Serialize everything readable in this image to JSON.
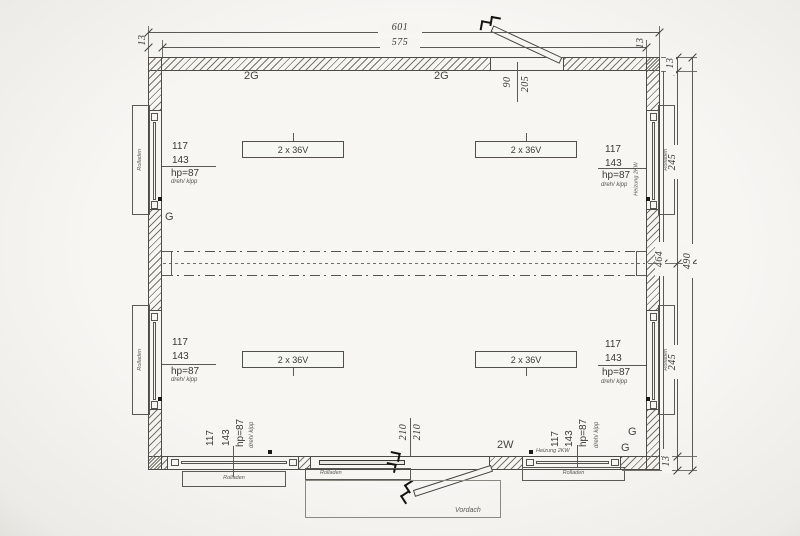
{
  "dimensions": {
    "outer_width": "601",
    "inner_width": "575",
    "wall_thickness": "13",
    "door_top_width": "90",
    "door_top_height": "205",
    "right_upper": "245",
    "right_lower": "245",
    "inner_height": "464",
    "outer_height": "490",
    "door_bottom_width": "210",
    "door_bottom_height": "210"
  },
  "room_labels": {
    "top_left": "2G",
    "top_center": "2G",
    "left_mid": "G",
    "corner_upper": "G",
    "corner_lower": "G",
    "door": "2W"
  },
  "window_spec": {
    "width": "117",
    "height": "143",
    "parapet": "hp=87",
    "type": "dreh/ kipp"
  },
  "fixtures": {
    "rolladen": "Rolladen",
    "heizung": "Heizung 2KW",
    "light": "2 x 36V",
    "vordach": "Vordach"
  },
  "colors": {
    "paper": "#f5f4f1",
    "line": "#45443f",
    "hatch": "#6e6d66",
    "text": "#3a3934"
  }
}
